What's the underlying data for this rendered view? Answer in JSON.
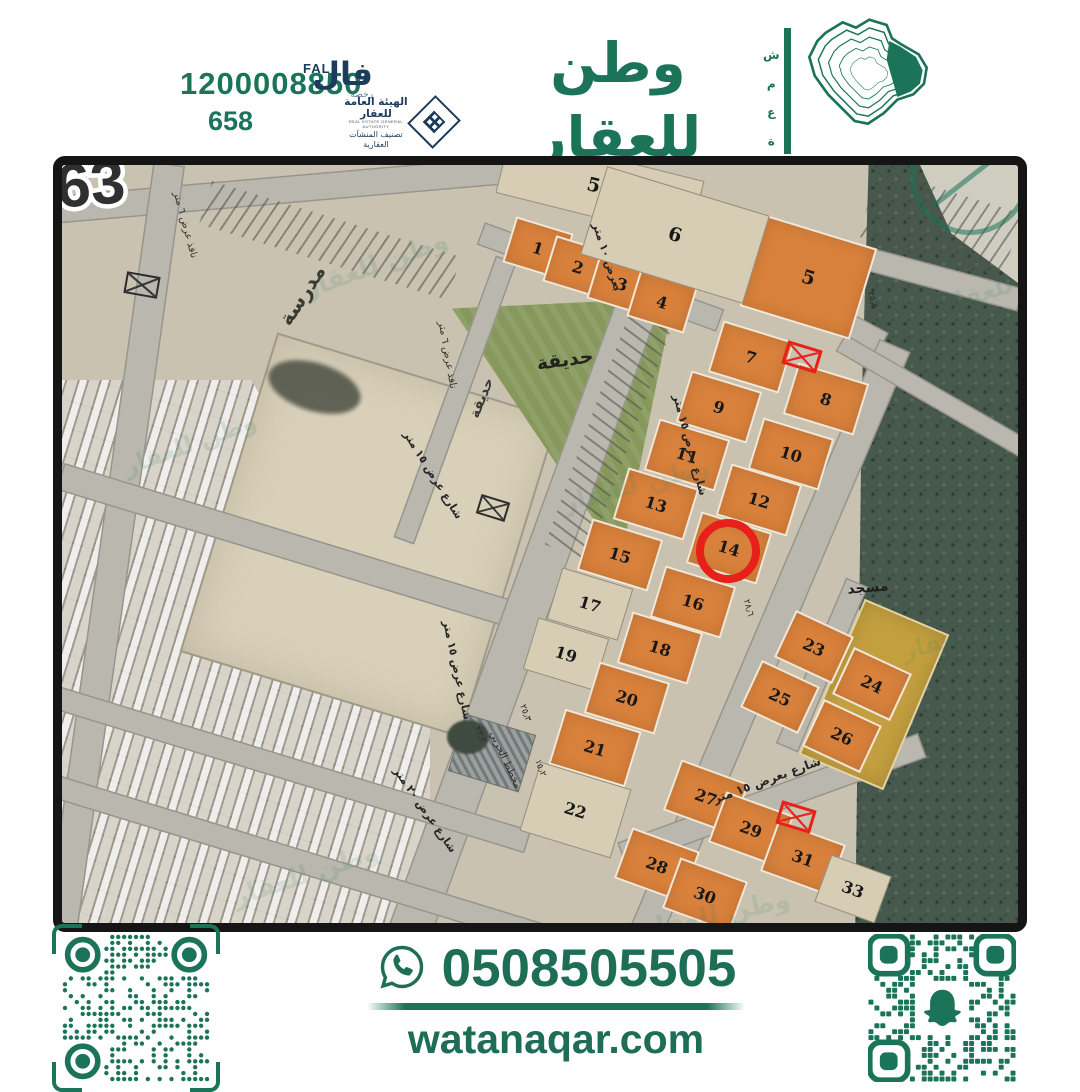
{
  "colors": {
    "green": "#1c7458",
    "navy": "#1c3c5e",
    "red": "#e8201a",
    "orange": "#d8813c"
  },
  "header": {
    "contact_number": "1200008850",
    "license_number": "658",
    "fal": {
      "latin": "FAL",
      "arabic": "فال",
      "sub": "رخصة"
    },
    "authority": {
      "line1": "الهيئة العامة للعقار",
      "line2": "REAL ESTATE GENERAL AUTHORITY",
      "line3": "تصنيف المنشآت العقارية"
    },
    "brand": {
      "ar": "وطن للعقار",
      "en": "WATAN REAL ESTATE",
      "vertical": "شمعة"
    }
  },
  "map": {
    "district_number": "63",
    "watermark": "وطن للعقار",
    "plots": [
      {
        "n": "1",
        "x": 476,
        "y": 83,
        "w": 60,
        "h": 48,
        "t": "orange",
        "r": 17
      },
      {
        "n": "2",
        "x": 516,
        "y": 102,
        "w": 60,
        "h": 48,
        "t": "orange",
        "r": 17
      },
      {
        "n": "3",
        "x": 560,
        "y": 119,
        "w": 60,
        "h": 48,
        "t": "orange",
        "r": 17
      },
      {
        "n": "4",
        "x": 600,
        "y": 137,
        "w": 60,
        "h": 48,
        "t": "orange",
        "r": 17
      },
      {
        "n": "5",
        "x": 746,
        "y": 112,
        "w": 115,
        "h": 95,
        "t": "orange big",
        "r": 17
      },
      {
        "n": "58",
        "x": 538,
        "y": 22,
        "w": 200,
        "h": 62,
        "t": "beige big",
        "r": 14
      },
      {
        "n": "6",
        "x": 613,
        "y": 70,
        "w": 170,
        "h": 92,
        "t": "beige big",
        "r": 17
      },
      {
        "n": "7",
        "x": 689,
        "y": 192,
        "w": 74,
        "h": 54,
        "t": "orange",
        "r": 17
      },
      {
        "n": "8",
        "x": 764,
        "y": 234,
        "w": 74,
        "h": 54,
        "t": "orange",
        "r": 17
      },
      {
        "n": "9",
        "x": 657,
        "y": 242,
        "w": 74,
        "h": 54,
        "t": "orange",
        "r": 17
      },
      {
        "n": "10",
        "x": 729,
        "y": 289,
        "w": 74,
        "h": 54,
        "t": "orange",
        "r": 17
      },
      {
        "n": "11",
        "x": 625,
        "y": 290,
        "w": 74,
        "h": 54,
        "t": "orange",
        "r": 17
      },
      {
        "n": "12",
        "x": 697,
        "y": 335,
        "w": 74,
        "h": 54,
        "t": "orange",
        "r": 17
      },
      {
        "n": "13",
        "x": 594,
        "y": 339,
        "w": 74,
        "h": 54,
        "t": "orange",
        "r": 17
      },
      {
        "n": "14",
        "x": 667,
        "y": 383,
        "w": 74,
        "h": 54,
        "t": "orange",
        "r": 17
      },
      {
        "n": "15",
        "x": 558,
        "y": 390,
        "w": 74,
        "h": 54,
        "t": "orange",
        "r": 17
      },
      {
        "n": "16",
        "x": 631,
        "y": 437,
        "w": 74,
        "h": 54,
        "t": "orange",
        "r": 17
      },
      {
        "n": "17",
        "x": 528,
        "y": 439,
        "w": 74,
        "h": 54,
        "t": "beige",
        "r": 17
      },
      {
        "n": "18",
        "x": 598,
        "y": 483,
        "w": 74,
        "h": 54,
        "t": "orange",
        "r": 17
      },
      {
        "n": "19",
        "x": 504,
        "y": 489,
        "w": 74,
        "h": 54,
        "t": "beige",
        "r": 17
      },
      {
        "n": "20",
        "x": 565,
        "y": 533,
        "w": 74,
        "h": 54,
        "t": "orange",
        "r": 17
      },
      {
        "n": "21",
        "x": 533,
        "y": 583,
        "w": 80,
        "h": 58,
        "t": "orange",
        "r": 17
      },
      {
        "n": "22",
        "x": 513,
        "y": 645,
        "w": 95,
        "h": 72,
        "t": "beige",
        "r": 17
      },
      {
        "n": "23",
        "x": 752,
        "y": 482,
        "w": 64,
        "h": 52,
        "t": "orange",
        "r": 25
      },
      {
        "n": "24",
        "x": 810,
        "y": 519,
        "w": 64,
        "h": 52,
        "t": "orange",
        "r": 25
      },
      {
        "n": "25",
        "x": 718,
        "y": 532,
        "w": 64,
        "h": 52,
        "t": "orange",
        "r": 25
      },
      {
        "n": "26",
        "x": 780,
        "y": 571,
        "w": 64,
        "h": 52,
        "t": "orange",
        "r": 25
      },
      {
        "n": "27",
        "x": 644,
        "y": 632,
        "w": 72,
        "h": 54,
        "t": "orange",
        "r": 20
      },
      {
        "n": "28",
        "x": 595,
        "y": 700,
        "w": 72,
        "h": 54,
        "t": "orange",
        "r": 20
      },
      {
        "n": "29",
        "x": 689,
        "y": 664,
        "w": 72,
        "h": 54,
        "t": "orange",
        "r": 20
      },
      {
        "n": "30",
        "x": 643,
        "y": 730,
        "w": 72,
        "h": 54,
        "t": "orange",
        "r": 20
      },
      {
        "n": "31",
        "x": 741,
        "y": 693,
        "w": 72,
        "h": 54,
        "t": "orange",
        "r": 20
      },
      {
        "n": "33",
        "x": 791,
        "y": 724,
        "w": 64,
        "h": 50,
        "t": "beige",
        "r": 20
      }
    ],
    "labels": [
      {
        "t": "مدرسة",
        "x": 240,
        "y": 130,
        "r": -57,
        "s": 20,
        "w": 600,
        "c": "#3a3a35"
      },
      {
        "t": "حديقة",
        "x": 503,
        "y": 195,
        "r": -8,
        "s": 19,
        "w": 700,
        "c": "#222"
      },
      {
        "t": "حديقة",
        "x": 420,
        "y": 233,
        "r": -68,
        "s": 14,
        "w": 600,
        "c": "#3a3a35"
      },
      {
        "t": "مسجد",
        "x": 806,
        "y": 423,
        "r": -5,
        "s": 14,
        "w": 700,
        "c": "#1d1d1d"
      },
      {
        "t": "بعرض ١٠ متر",
        "x": 545,
        "y": 92,
        "r": 72,
        "s": 11,
        "w": 600,
        "c": "#252525"
      },
      {
        "t": "شارع بعرض ١٥ متر",
        "x": 628,
        "y": 280,
        "r": 75,
        "s": 11,
        "w": 600,
        "c": "#252525"
      },
      {
        "t": "شارع عرض ١٥ متر",
        "x": 371,
        "y": 310,
        "r": 58,
        "s": 11,
        "w": 600,
        "c": "#252525"
      },
      {
        "t": "شارع عرض ١٥ متر",
        "x": 395,
        "y": 505,
        "r": 78,
        "s": 11,
        "w": 600,
        "c": "#252525"
      },
      {
        "t": "شارع عرض ٢٠ متر",
        "x": 363,
        "y": 645,
        "r": 55,
        "s": 11,
        "w": 600,
        "c": "#252525"
      },
      {
        "t": "شارع بعرض ١٥ متر",
        "x": 705,
        "y": 615,
        "r": -20,
        "s": 12,
        "w": 600,
        "c": "#252525"
      },
      {
        "t": "نافذ عرض ٦ متر",
        "x": 385,
        "y": 190,
        "r": 80,
        "s": 10,
        "w": 500,
        "c": "#33332e"
      },
      {
        "t": "نافذ عرض ٦ متر",
        "x": 123,
        "y": 60,
        "r": 75,
        "s": 10,
        "w": 500,
        "c": "#33332e"
      },
      {
        "t": "مخطط الحربي",
        "x": 443,
        "y": 595,
        "r": 65,
        "s": 10,
        "w": 500,
        "c": "#2c2c28"
      },
      {
        "t": "٢٥٫٣",
        "x": 463,
        "y": 548,
        "r": 70,
        "s": 9,
        "w": 500,
        "c": "#2c2c28"
      },
      {
        "t": "١٥٫٢",
        "x": 478,
        "y": 603,
        "r": 70,
        "s": 9,
        "w": 500,
        "c": "#2c2c28"
      },
      {
        "t": "٢٣٫٢",
        "x": 418,
        "y": 570,
        "r": 65,
        "s": 9,
        "w": 500,
        "c": "#2c2c28"
      },
      {
        "t": "٢٨٫٦",
        "x": 686,
        "y": 443,
        "r": 75,
        "s": 9,
        "w": 500,
        "c": "#2c2c28"
      },
      {
        "t": "٢٥٫٥",
        "x": 810,
        "y": 135,
        "r": 75,
        "s": 9,
        "w": 500,
        "c": "#2c2c28"
      }
    ],
    "markers": [
      {
        "type": "red-circle",
        "x": 666,
        "y": 386,
        "d": 64
      },
      {
        "type": "red-xbox",
        "x": 740,
        "y": 192,
        "w": 36,
        "h": 24,
        "r": 17
      },
      {
        "type": "red-xbox",
        "x": 734,
        "y": 652,
        "w": 36,
        "h": 24,
        "r": 17
      },
      {
        "type": "black-xbox",
        "x": 431,
        "y": 343,
        "w": 30,
        "h": 20,
        "r": 17
      },
      {
        "type": "black-xbox",
        "x": 80,
        "y": 120,
        "w": 34,
        "h": 22,
        "r": 10
      }
    ],
    "roads": [
      {
        "x": 220,
        "y": 25,
        "w": 460,
        "h": 28,
        "r": -5
      },
      {
        "x": 538,
        "y": 112,
        "w": 255,
        "h": 24,
        "r": 20
      },
      {
        "x": 728,
        "y": 130,
        "w": 210,
        "h": 26,
        "r": 28
      },
      {
        "x": 828,
        "y": 100,
        "w": 270,
        "h": 24,
        "r": 15
      },
      {
        "x": 53,
        "y": 385,
        "w": 32,
        "h": 780,
        "r": 8
      },
      {
        "x": 223,
        "y": 380,
        "w": 470,
        "h": 28,
        "r": 17
      },
      {
        "x": 483,
        "y": 395,
        "w": 44,
        "h": 800,
        "r": 20
      },
      {
        "x": 708,
        "y": 475,
        "w": 34,
        "h": 640,
        "r": 23
      },
      {
        "x": 710,
        "y": 635,
        "w": 320,
        "h": 26,
        "r": -20
      },
      {
        "x": 878,
        "y": 235,
        "w": 230,
        "h": 20,
        "r": 30
      },
      {
        "x": 198,
        "y": 595,
        "w": 560,
        "h": 24,
        "r": 17
      },
      {
        "x": 250,
        "y": 700,
        "w": 600,
        "h": 24,
        "r": 17
      },
      {
        "x": 393,
        "y": 235,
        "w": 22,
        "h": 300,
        "r": 20
      },
      {
        "x": 760,
        "y": 500,
        "w": 24,
        "h": 180,
        "r": 23
      }
    ],
    "hatches": [
      {
        "x": 878,
        "y": 60,
        "w": 150,
        "h": 70,
        "r": 17,
        "a": 107
      },
      {
        "x": 268,
        "y": 75,
        "w": 260,
        "h": 45,
        "r": 17,
        "a": 107
      },
      {
        "x": 548,
        "y": 265,
        "w": 45,
        "h": 260,
        "r": 20,
        "a": 17
      }
    ],
    "watermarks": [
      {
        "x": 238,
        "y": 85,
        "r": -20,
        "s": 26,
        "o": 0.14
      },
      {
        "x": 58,
        "y": 265,
        "r": -20,
        "s": 24,
        "o": 0.14
      },
      {
        "x": 878,
        "y": 105,
        "r": -18,
        "s": 24,
        "o": 0.12
      },
      {
        "x": 498,
        "y": 305,
        "r": -15,
        "s": 26,
        "o": 0.1
      },
      {
        "x": 838,
        "y": 455,
        "r": -15,
        "s": 24,
        "o": 0.12
      },
      {
        "x": 168,
        "y": 695,
        "r": -18,
        "s": 26,
        "o": 0.12
      },
      {
        "x": 578,
        "y": 735,
        "r": -12,
        "s": 26,
        "o": 0.12
      }
    ]
  },
  "footer": {
    "whatsapp_number": "0508505505",
    "website": "watanaqar.com",
    "qr_left": {
      "modules": 25,
      "seed": 13,
      "style": "dots"
    },
    "qr_right": {
      "modules": 25,
      "seed": 99,
      "style": "squares",
      "ghost": true
    }
  }
}
